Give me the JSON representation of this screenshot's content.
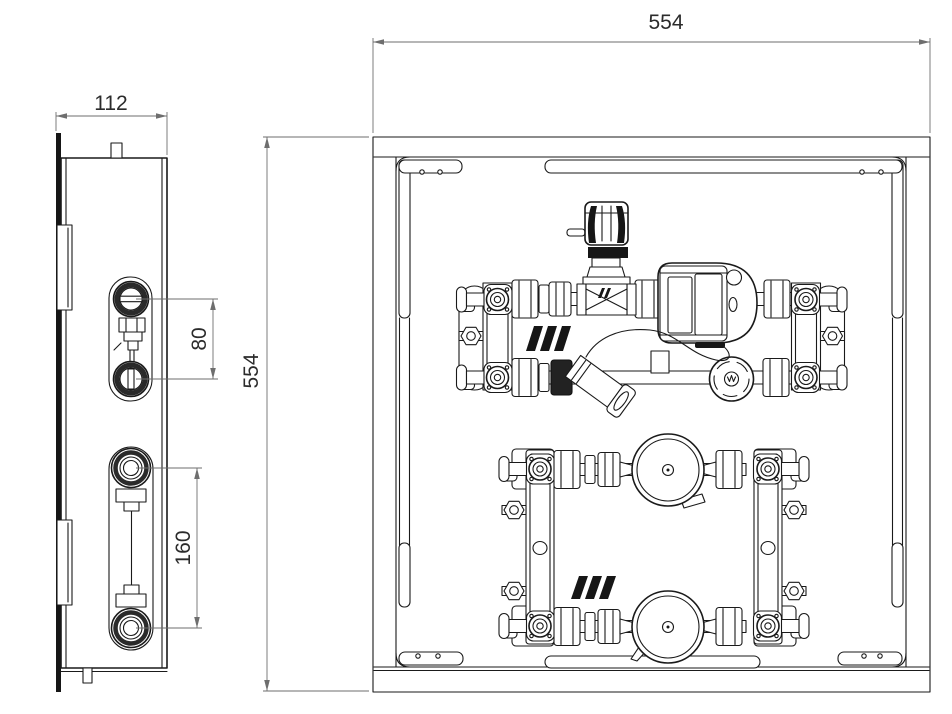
{
  "drawing": {
    "description_note": "",
    "dimensions": {
      "front_width": "554",
      "front_height": "554",
      "side_depth": "112",
      "upper_ports_spacing": "80",
      "lower_ports_spacing": "160"
    },
    "colors": {
      "background": "#ffffff",
      "line": "#1a1a1a",
      "dimension_line": "#6e6e6e",
      "dimension_text": "#2b2b2b",
      "solid_fill": "#161616"
    }
  }
}
